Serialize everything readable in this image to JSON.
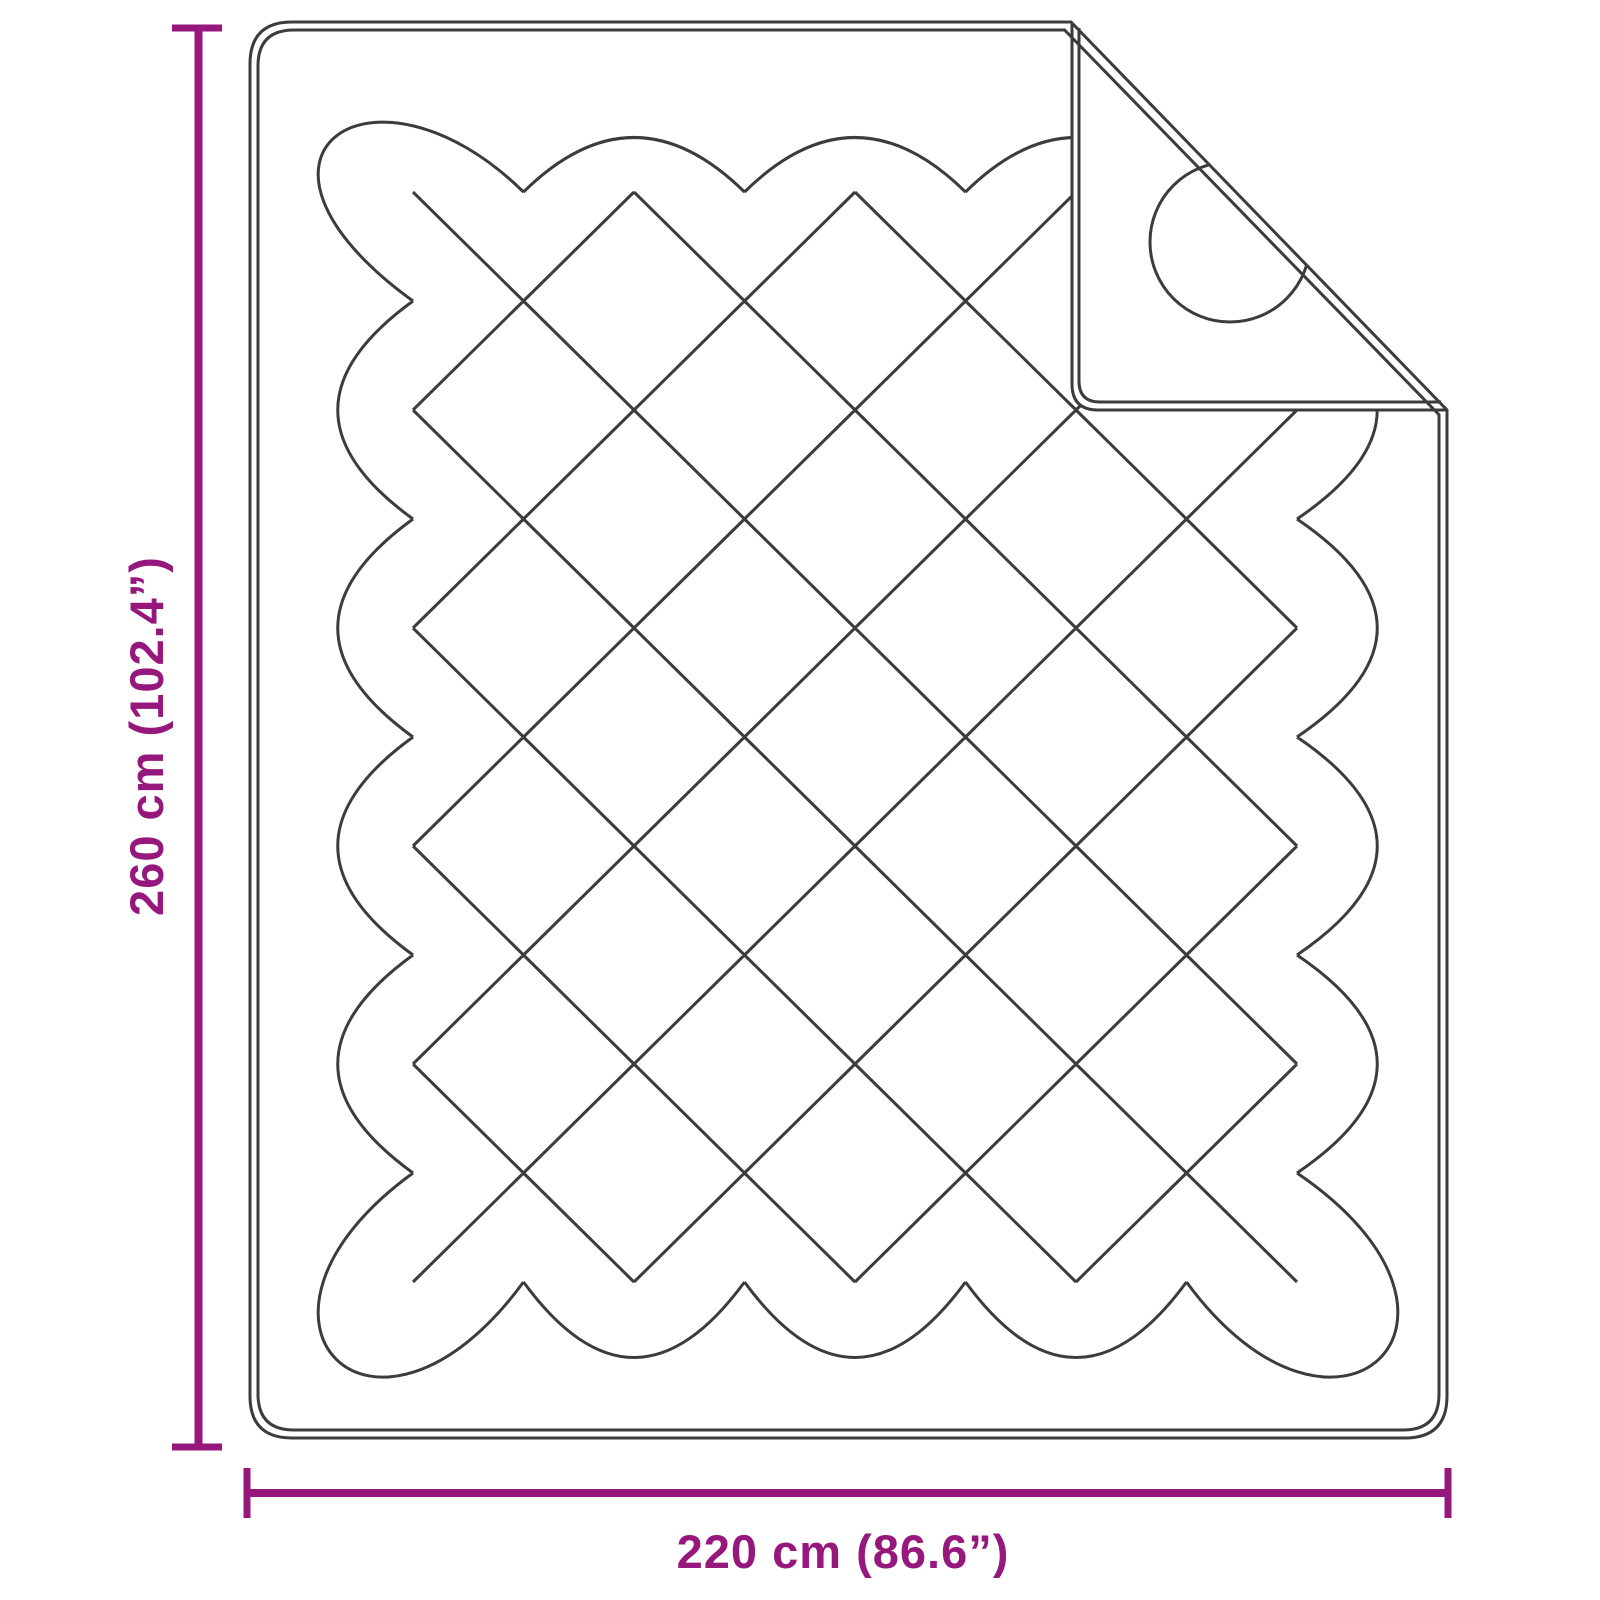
{
  "labels": {
    "height": "260 cm (102.4”)",
    "width": "220 cm (86.6”)"
  },
  "colors": {
    "accent": "#96187d",
    "line": "#3c3c3c",
    "background": "#ffffff"
  },
  "drawing": {
    "object": "quilted-blanket-top-view-with-folded-corner",
    "quilting": "diamond-lattice-stitch",
    "grid": {
      "x0": 302.5,
      "y0": 83,
      "cx": 110.5,
      "cy": 109,
      "cols": 10,
      "rows": 12
    },
    "overshoot": {
      "left": 40,
      "right": 50,
      "top": 0,
      "bottom": 42
    },
    "corner_factor": 1.35,
    "fold_circle": {
      "cx": 1230,
      "cy": 242,
      "r": 80
    }
  }
}
